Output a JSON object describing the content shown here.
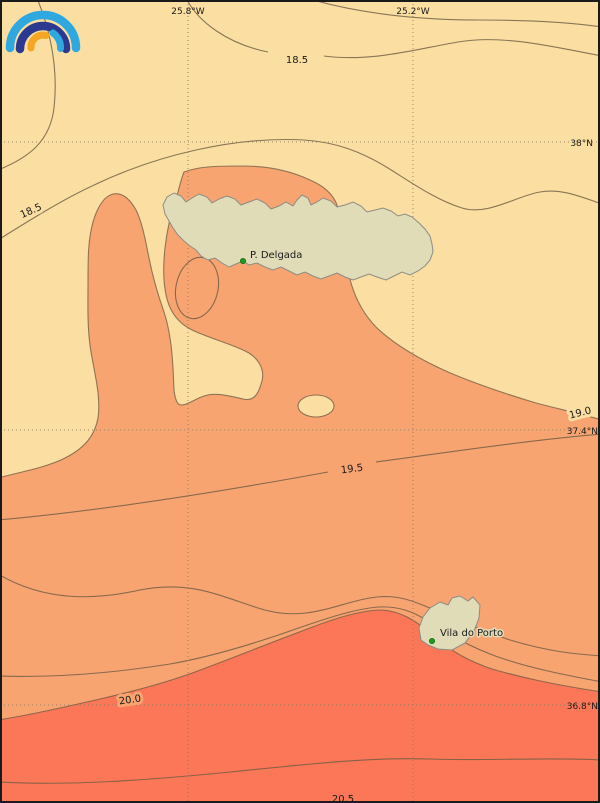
{
  "map": {
    "kind": "sea-surface-temperature contour map",
    "coordinate_labels": {
      "meridians": [
        {
          "label": "25.8°W"
        },
        {
          "label": "25.2°W"
        }
      ],
      "parallels": [
        {
          "label": "38°N"
        },
        {
          "label": "37.4°N"
        },
        {
          "label": "36.8°N"
        }
      ]
    },
    "contour_labels": [
      {
        "text": "18.5"
      },
      {
        "text": "18.5"
      },
      {
        "text": "19.0"
      },
      {
        "text": "19.5"
      },
      {
        "text": "20.0"
      },
      {
        "text": "20.5"
      }
    ],
    "places": [
      {
        "label": "P. Delgada"
      },
      {
        "label": "Vila do Porto"
      }
    ],
    "isotherm_levels_c": [
      18.5,
      19.0,
      19.5,
      20.0,
      20.5
    ],
    "colors": {
      "band_cool": "#FBDFA2",
      "band_mid": "#F8A471",
      "band_warm": "#FB7757",
      "island": "#E0DCB8",
      "island_outline": "#8C8C85",
      "contour_line": "#6B5A42",
      "grid_line": "#8F7A5F",
      "marker_green": "#1E9B1E",
      "frame": "#1a1a1a"
    },
    "logo": {
      "name": "rainbow-arcs-logo",
      "light_blue": "#2FA8DF",
      "dark_blue": "#2B3A8F",
      "orange": "#F5A623"
    }
  }
}
